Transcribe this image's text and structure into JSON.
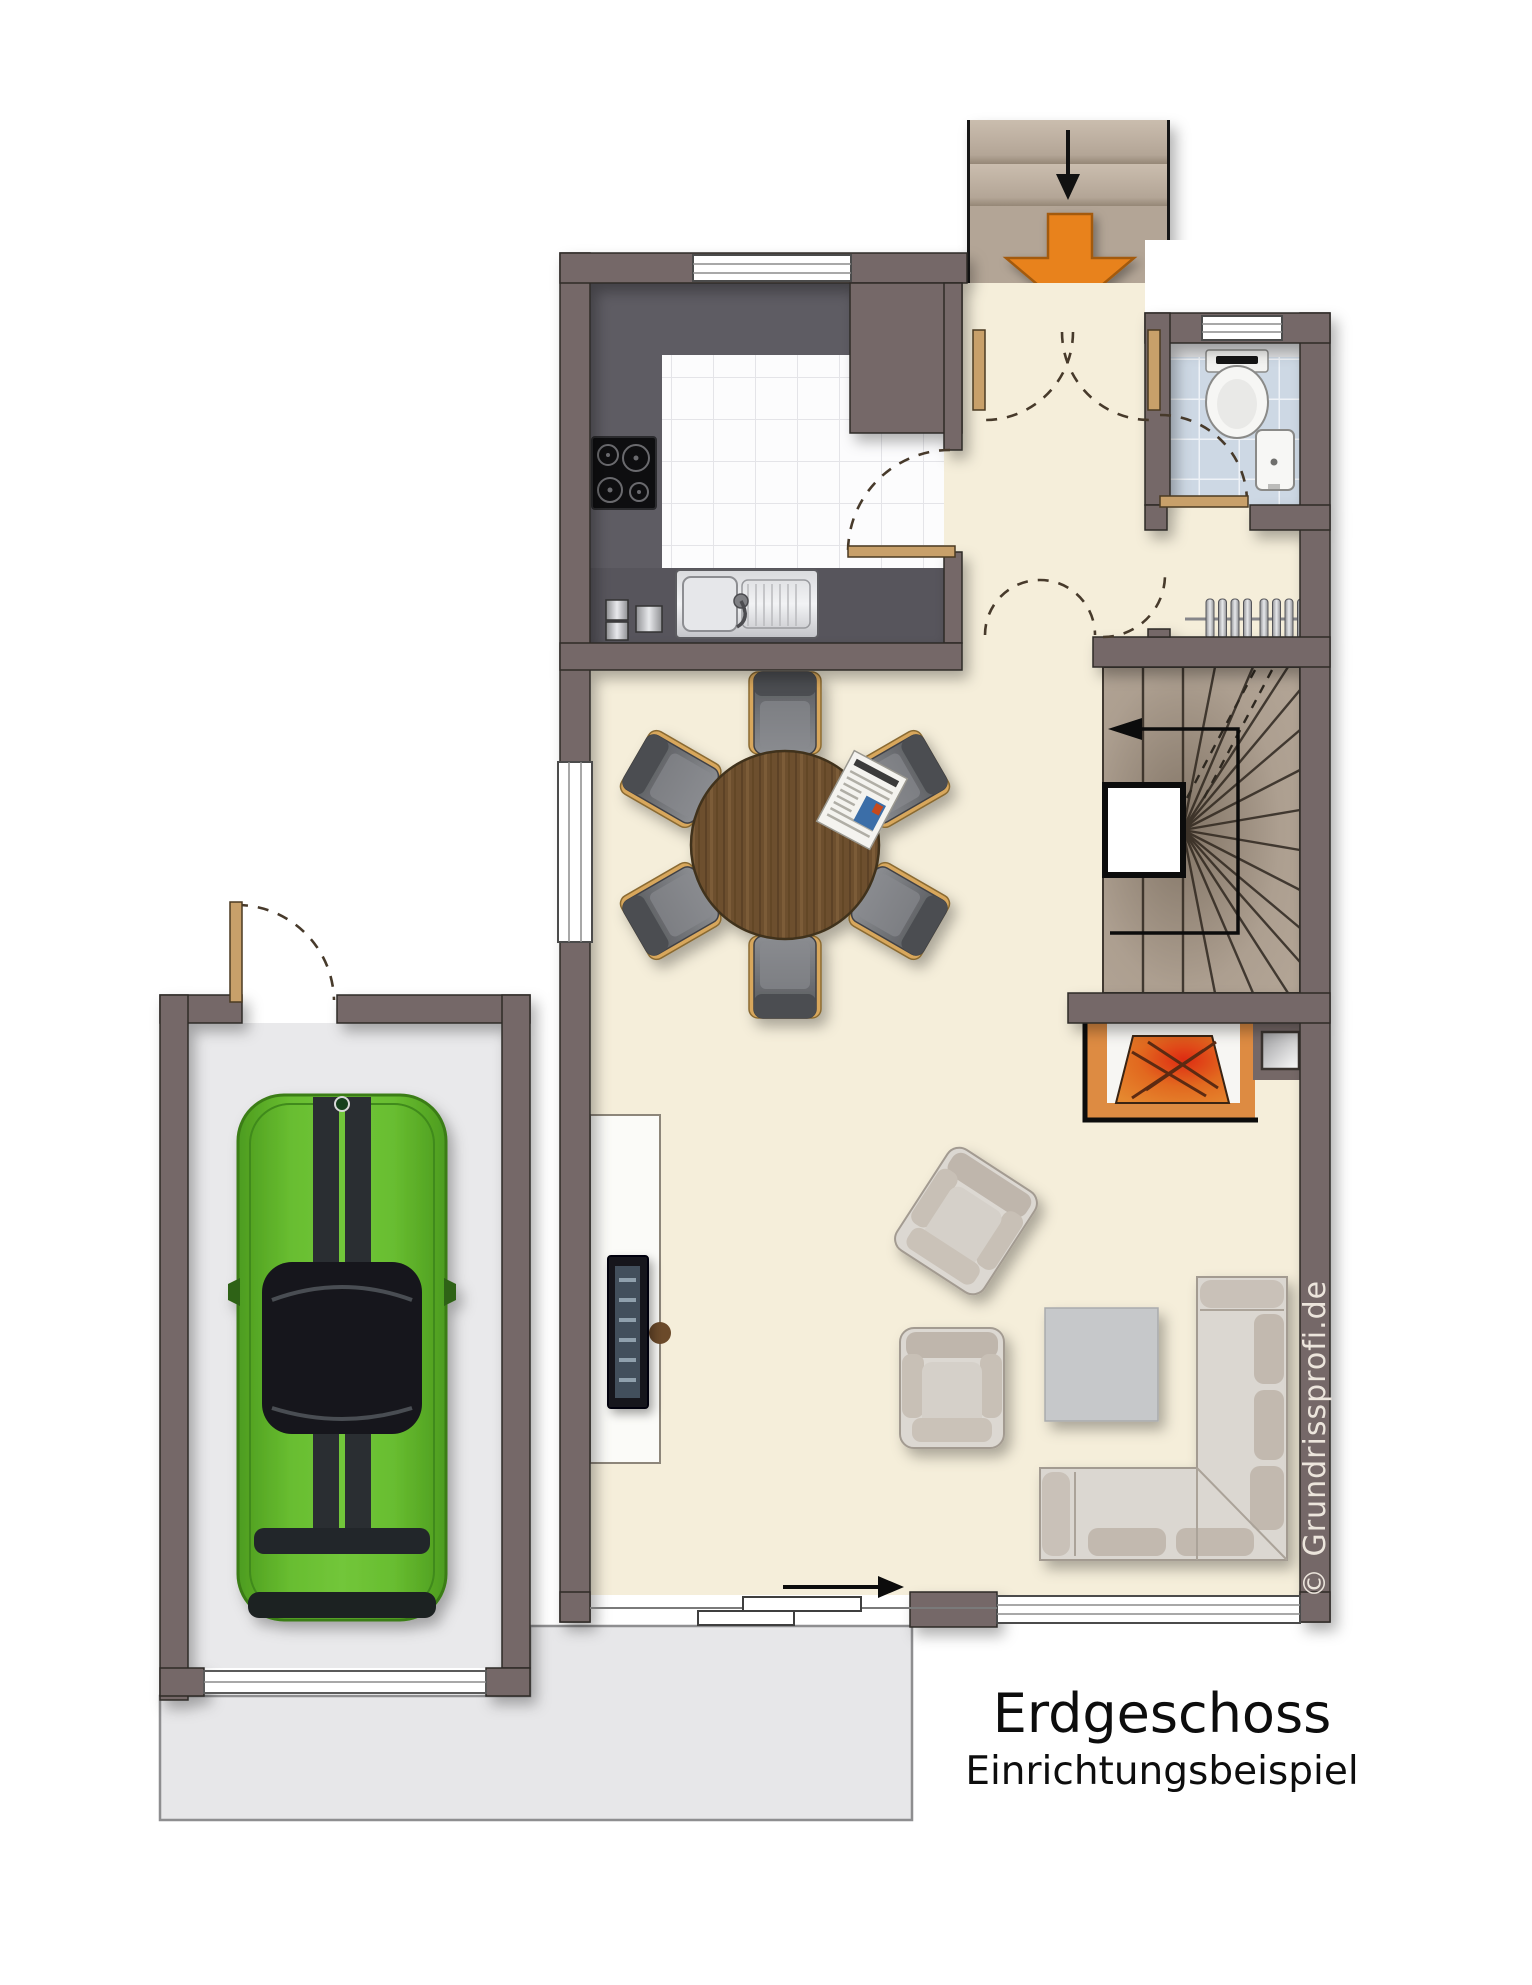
{
  "labels": {
    "title": "Erdgeschoss",
    "subtitle": "Einrichtungsbeispiel",
    "watermark": "© Grundrissprofi.de"
  },
  "palette": {
    "wall": "#756867",
    "interior_floor": "#f5eeda",
    "kitchen_counter": "#5e5c63",
    "kitchen_tile": "#fcfcfd",
    "bath_tile": "#cdd8e4",
    "porch_and_stairs": "#b3a596",
    "garage_floor": "#e9e9eb",
    "terrace": "#e7e7e9",
    "entrance_arrow_accent": "#e8821c",
    "fire_glow": "#d0321a",
    "car_green": "#5fb32a",
    "sofa_gray": "#dbd7d1",
    "table_wood": "#6d4f2e",
    "door_wood": "#c8a06a"
  },
  "plan": {
    "floor_name": "Erdgeschoss",
    "rooms": [
      {
        "name": "kitchen"
      },
      {
        "name": "entrance-hall"
      },
      {
        "name": "wc-bathroom"
      },
      {
        "name": "winder-staircase"
      },
      {
        "name": "living-dining-room"
      },
      {
        "name": "garage"
      },
      {
        "name": "entrance-porch"
      },
      {
        "name": "terrace-driveway"
      }
    ],
    "furniture": [
      "cooktop",
      "kitchen-sink",
      "waste-bins",
      "round-dining-table",
      "dining-chairs-x6",
      "newspaper",
      "radiator",
      "fireplace",
      "sideboard-with-tv",
      "armchair-x2",
      "coffee-table",
      "corner-sofa",
      "toilet",
      "washbasin",
      "sports-car"
    ],
    "annotations": {
      "entrance_direction": "down",
      "stair_walk_direction": "up, exiting left",
      "sliding_door_direction": "right"
    }
  }
}
